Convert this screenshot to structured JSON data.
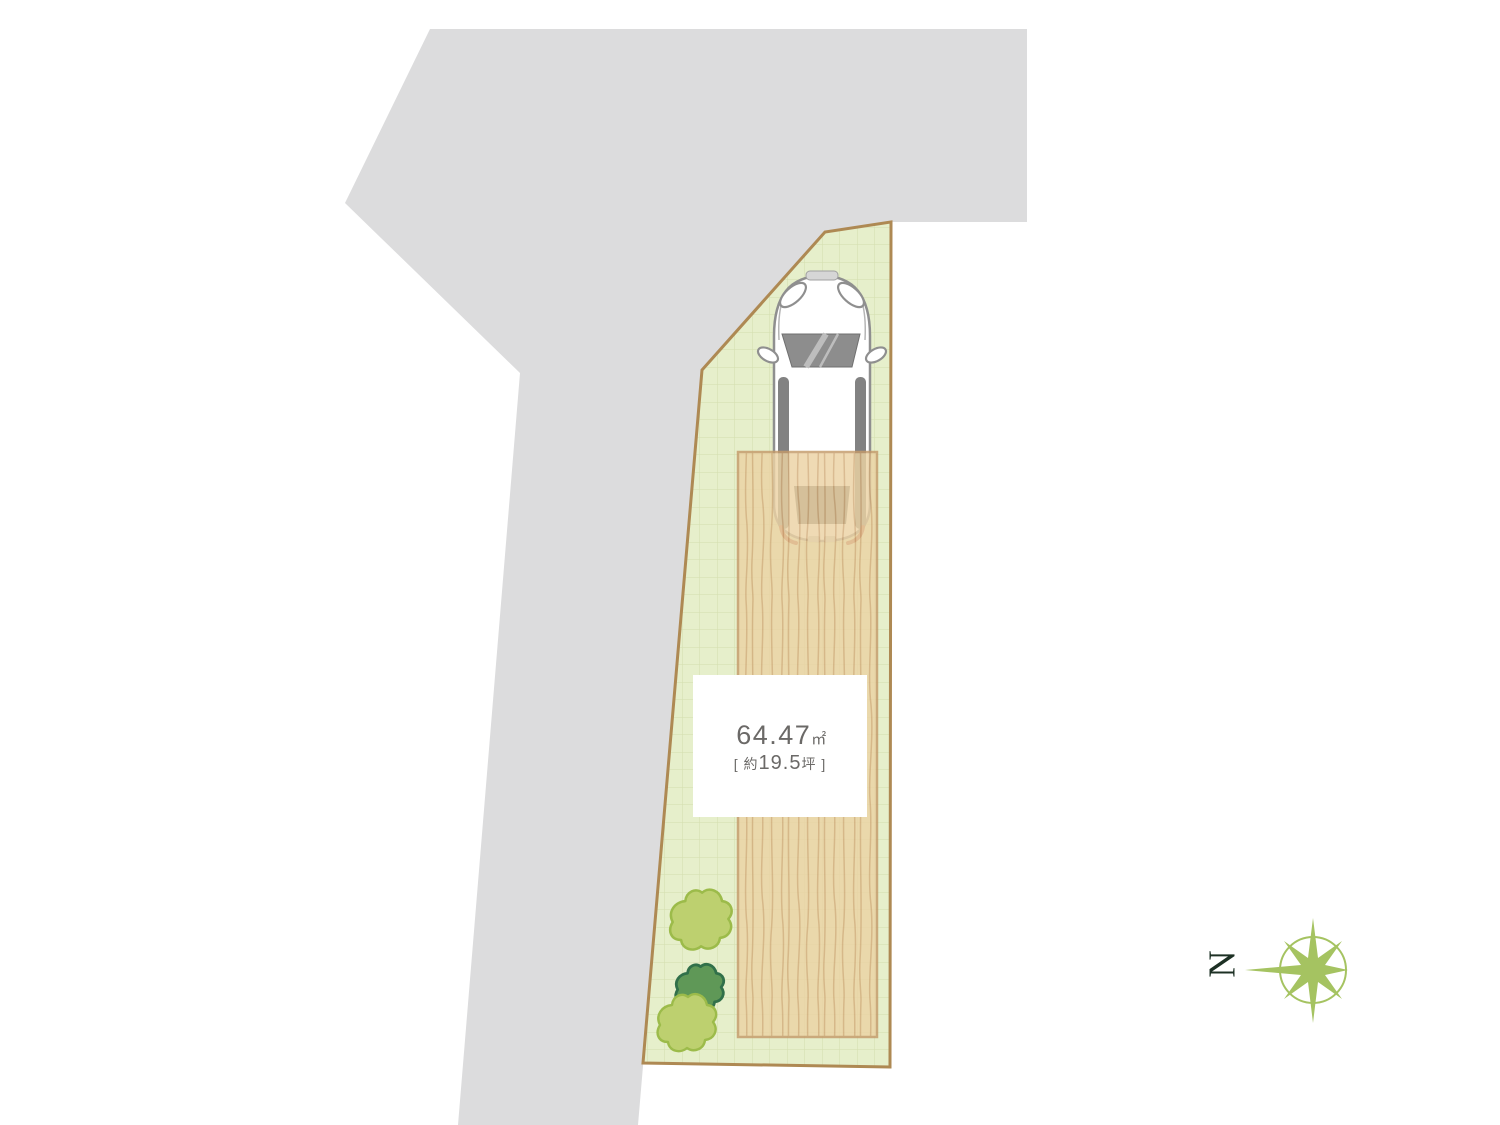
{
  "plan": {
    "area_label": {
      "value": "64.47",
      "unit": "㎡",
      "sub_prefix": "[ 約",
      "sub_value": "19.5",
      "sub_suffix": "坪 ]"
    },
    "compass": {
      "north_label": "N"
    }
  },
  "colors": {
    "background": "#ffffff",
    "road": "#dcdcdd",
    "lot_fill": "#e6efcb",
    "lot_grid": "#d3ddae",
    "lot_border": "#ae8953",
    "deck_fill": "#ecd3a4",
    "deck_grain": "#d3ad7b",
    "deck_border": "#c49a6a",
    "bush_light_fill": "#bdd06f",
    "bush_light_stroke": "#9cbb4a",
    "bush_dark_fill": "#5f9857",
    "bush_dark_stroke": "#31704a",
    "compass_green": "#a5c361",
    "compass_text": "#1d3024",
    "label_text": "#6b6967",
    "car_body": "#ffffff",
    "car_outline": "#8f8f8f",
    "car_glass": "#8d8d8d"
  }
}
